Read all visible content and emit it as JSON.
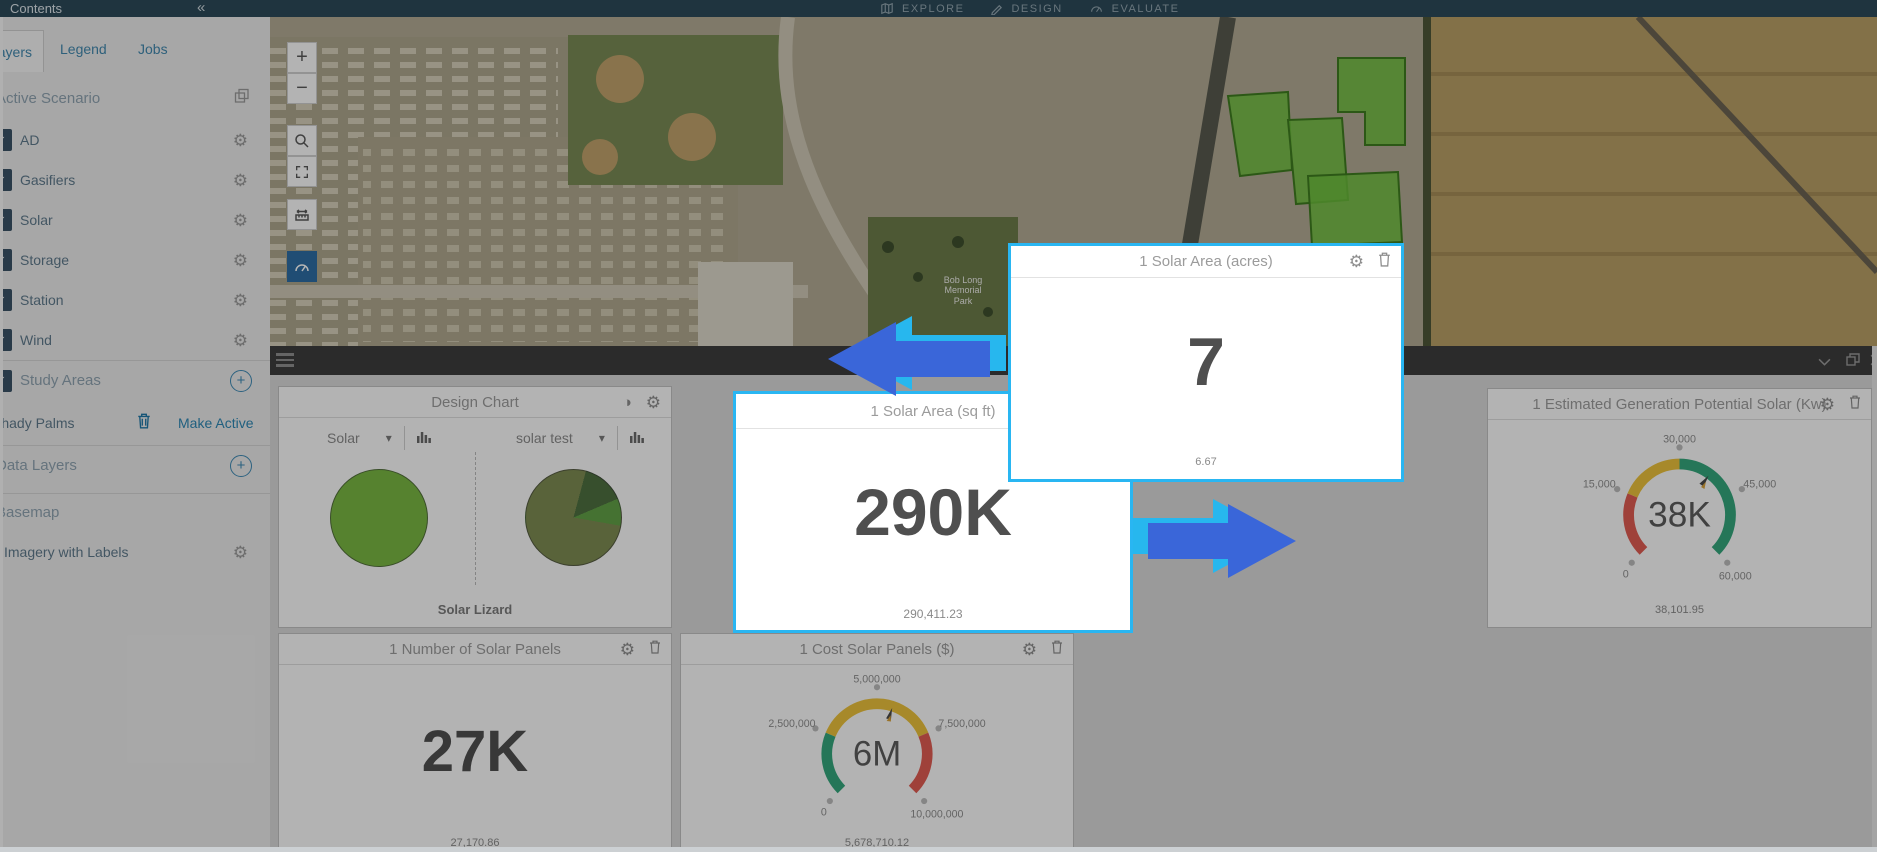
{
  "topbar": {
    "tabs": [
      {
        "label": "EXPLORE"
      },
      {
        "label": "DESIGN"
      },
      {
        "label": "EVALUATE"
      }
    ]
  },
  "sidebar": {
    "title": "Contents",
    "tabs": [
      {
        "label": "Layers"
      },
      {
        "label": "Legend"
      },
      {
        "label": "Jobs"
      }
    ],
    "sections": {
      "active_scenario": {
        "label": "Active Scenario"
      },
      "study_areas": {
        "label": "Study Areas"
      },
      "data_layers": {
        "label": "Data Layers"
      },
      "basemap": {
        "label": "Basemap"
      }
    },
    "layers": [
      {
        "label": "AD",
        "checked": true
      },
      {
        "label": "Gasifiers",
        "checked": true
      },
      {
        "label": "Solar",
        "checked": true
      },
      {
        "label": "Storage",
        "checked": true
      },
      {
        "label": "Station",
        "checked": true
      },
      {
        "label": "Wind",
        "checked": true
      }
    ],
    "scenario": {
      "name": "Shady Palms",
      "action": "Make Active"
    },
    "basemap_layer": {
      "label": "Imagery with Labels"
    }
  },
  "map": {
    "park_label": {
      "line1": "Bob Long",
      "line2": "Memorial",
      "line3": "Park"
    }
  },
  "dashboard": {
    "design_chart": {
      "title": "Design Chart",
      "left_select": "Solar",
      "right_select": "solar test",
      "footer": "Solar Lizard"
    },
    "solar_area_sqft": {
      "title": "1 Solar Area (sq ft)",
      "value": "290K",
      "footer": "290,411.23"
    },
    "solar_area_acres": {
      "title": "1 Solar Area (acres)",
      "value": "7",
      "footer": "6.67"
    },
    "generation": {
      "title": "1 Estimated Generation Potential Solar (Kw)",
      "value": "38K",
      "footer": "38,101.95",
      "ticks": [
        "0",
        "15,000",
        "30,000",
        "45,000",
        "60,000"
      ]
    },
    "panels": {
      "title": "1 Number of Solar Panels",
      "value": "27K",
      "footer": "27,170.86"
    },
    "cost": {
      "title": "1 Cost Solar Panels ($)",
      "value": "6M",
      "footer": "5,678,710.12",
      "ticks": [
        "0",
        "2,500,000",
        "5,000,000",
        "7,500,000",
        "10,000,000"
      ]
    }
  },
  "chart_data": [
    {
      "type": "pie",
      "title": "Design Chart - Solar",
      "categories": [
        "Solar"
      ],
      "values": [
        100
      ],
      "colors": [
        "#79b843"
      ]
    },
    {
      "type": "pie",
      "title": "Design Chart - solar test",
      "categories": [
        "slice-1",
        "slice-2",
        "slice-3"
      ],
      "values": [
        78,
        13,
        9
      ],
      "colors": [
        "#7e8c52",
        "#4e7040",
        "#62a147"
      ]
    },
    {
      "type": "gauge",
      "title": "1 Estimated Generation Potential Solar (Kw)",
      "value": 38101.95,
      "display": "38K",
      "min": 0,
      "max": 60000,
      "ticks": [
        0,
        15000,
        30000,
        45000,
        60000
      ],
      "bands": [
        {
          "to": 15000,
          "color": "#e05c52"
        },
        {
          "to": 30000,
          "color": "#ecc23c"
        },
        {
          "to": 60000,
          "color": "#35a67c"
        }
      ]
    },
    {
      "type": "gauge",
      "title": "1 Cost Solar Panels ($)",
      "value": 5678710.12,
      "display": "6M",
      "min": 0,
      "max": 10000000,
      "ticks": [
        0,
        2500000,
        5000000,
        7500000,
        10000000
      ],
      "bands": [
        {
          "to": 2500000,
          "color": "#35a67c"
        },
        {
          "to": 7500000,
          "color": "#ecc23c"
        },
        {
          "to": 10000000,
          "color": "#e05c52"
        }
      ]
    },
    {
      "type": "number",
      "title": "1 Solar Area (sq ft)",
      "value": 290411.23,
      "display": "290K"
    },
    {
      "type": "number",
      "title": "1 Solar Area (acres)",
      "value": 6.67,
      "display": "7"
    },
    {
      "type": "number",
      "title": "1 Number of Solar Panels",
      "value": 27170.86,
      "display": "27K"
    }
  ],
  "colors": {
    "accent_cyan": "#29b6f2",
    "arrow_blue": "#3a66d9",
    "arrow_cyan": "#27b7ee",
    "gauge_red": "#e05c52",
    "gauge_yellow": "#ecc23c",
    "gauge_green": "#35a67c",
    "pie_green": "#79b843",
    "topbar_teal": "#2d4a59"
  }
}
